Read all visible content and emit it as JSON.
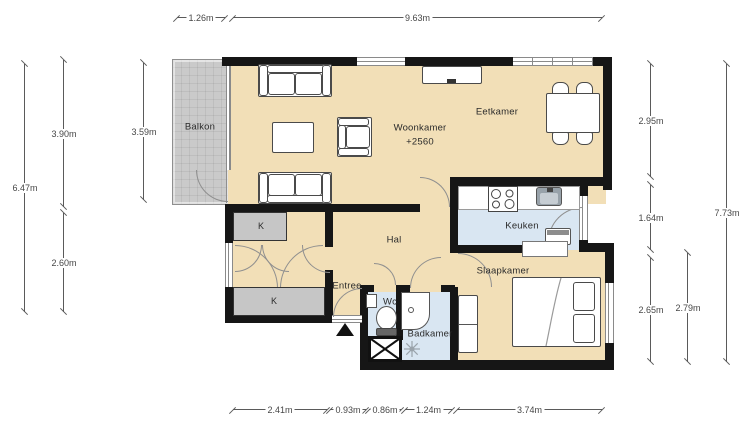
{
  "plan": {
    "rooms": {
      "balkon": "Balkon",
      "woonkamer": "Woonkamer",
      "woonkamer_elevation": "+2560",
      "eetkamer": "Eetkamer",
      "hal": "Hal",
      "keuken": "Keuken",
      "slaapkamer": "Slaapkamer",
      "entree": "Entree",
      "wc": "Wc",
      "badkamer": "Badkamer",
      "closet_top": "K",
      "closet_bottom": "K"
    },
    "dims": {
      "top": [
        "1.26m",
        "9.63m"
      ],
      "left": [
        "6.47m",
        "3.90m",
        "2.60m",
        "3.59m"
      ],
      "right": [
        "2.95m",
        "1.64m",
        "2.65m",
        "2.79m",
        "7.73m"
      ],
      "bottom": [
        "2.41m",
        "0.93m",
        "0.86m",
        "1.24m",
        "3.74m"
      ]
    },
    "colors": {
      "floor": "#f2dfb7",
      "wet_floor": "#d9e6f2",
      "balcony": "#cacaca",
      "closet": "#c6c6c6",
      "wall": "#161616"
    }
  }
}
